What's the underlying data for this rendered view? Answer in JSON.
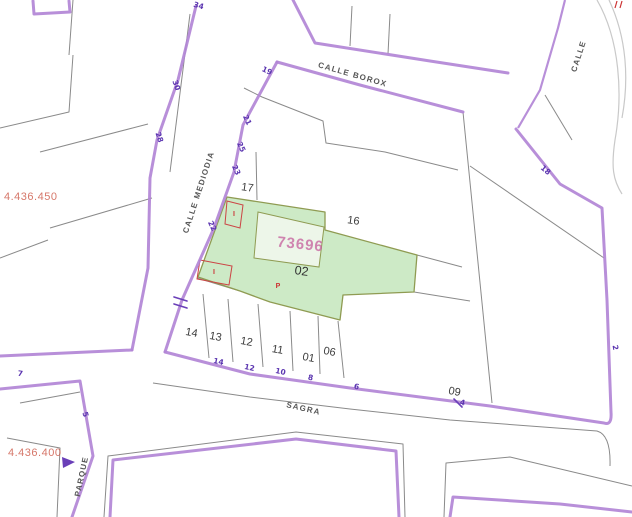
{
  "map": {
    "streets": [
      {
        "id": "calle-borox",
        "label": "CALLE BOROX"
      },
      {
        "id": "calle-mediodia",
        "label": "CALLE MEDIODIA"
      },
      {
        "id": "calle",
        "label": "CALLE"
      },
      {
        "id": "sagra",
        "label": "SAGRA"
      },
      {
        "id": "parque",
        "label": "PARQUE"
      }
    ],
    "grid_coordinates": [
      {
        "label": "4.436.450"
      },
      {
        "label": "4.436.400"
      }
    ],
    "selected_parcel": {
      "code": "73696",
      "number": "02",
      "interior_marks": [
        "I",
        "I",
        "P"
      ]
    },
    "parcel_numbers": [
      "17",
      "16",
      "14",
      "13",
      "12",
      "11",
      "01",
      "06",
      "09"
    ],
    "house_numbers": [
      "34",
      "30",
      "28",
      "19",
      "21",
      "25",
      "23",
      "22",
      "18",
      "2",
      "14",
      "12",
      "10",
      "8",
      "6",
      "4",
      "7",
      "5"
    ],
    "icons": [
      {
        "name": "street-arrow-icon"
      },
      {
        "name": "street-chevron-icon"
      },
      {
        "name": "coordinate-tick-icon"
      }
    ],
    "colors": {
      "block_boundary": "#b286d6",
      "parcel_line": "#8a8a8a",
      "road_curve": "#c9c9c9",
      "selected_fill": "#cdeac6",
      "selected_border": "#8f9b52",
      "parcel_code_text": "#c765a0",
      "coordinate_text": "#cc5544",
      "house_number_text": "#5b35b0"
    }
  }
}
